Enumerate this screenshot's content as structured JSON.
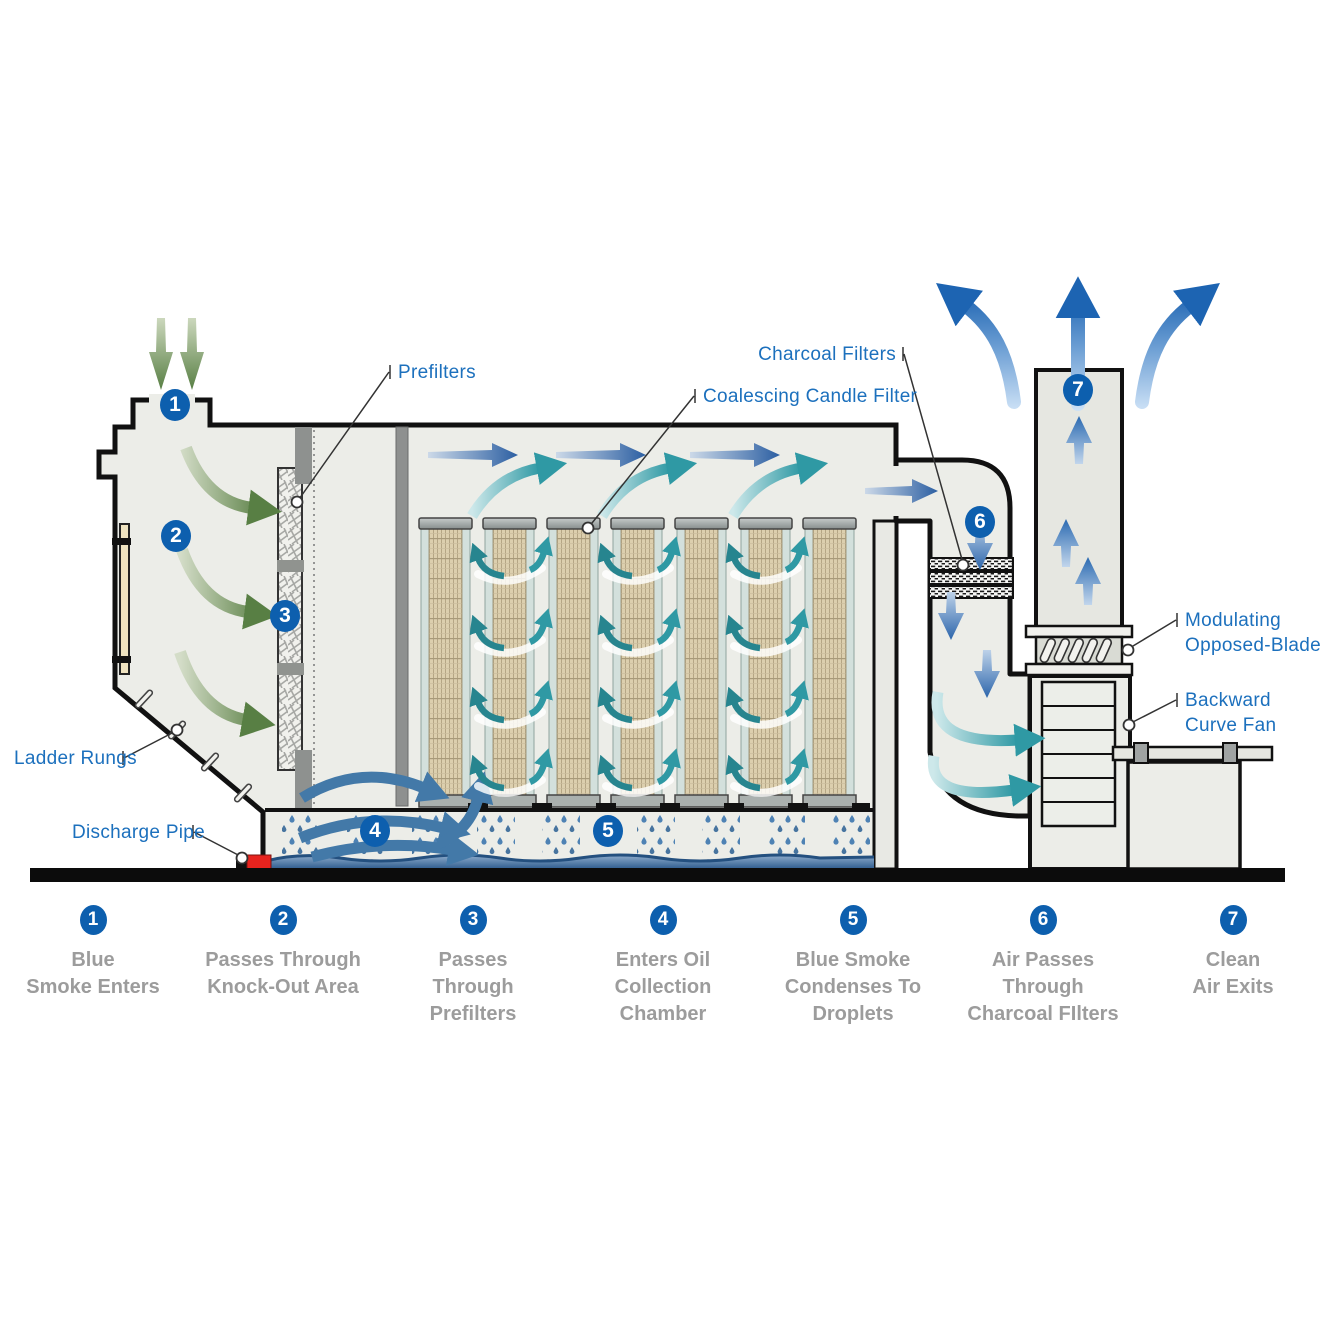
{
  "diagram": {
    "steps": [
      "1",
      "2",
      "3",
      "4",
      "5",
      "6",
      "7"
    ],
    "callouts": {
      "prefilters": "Prefilters",
      "coalescing": "Coalescing Candle Filter",
      "charcoal": "Charcoal Filters",
      "modulating_line1": "Modulating",
      "modulating_line2": "Opposed-Blade",
      "fan_line1": "Backward",
      "fan_line2": "Curve Fan",
      "ladder": "Ladder Rungs",
      "discharge": "Discharge Pipe"
    },
    "icons": {
      "inlet_arrows": "green-down-arrows",
      "exit_arrows": "blue-exit-arrows",
      "airflow_arrows": "blue-right-arrows",
      "swirl_arrows": "teal-swirl-arrows"
    },
    "colors": {
      "label_blue": "#1c70bd",
      "circle_blue": "#0d5fae",
      "legend_gray": "#9c9c9c",
      "housing_fill": "#ecede8",
      "green_arrow": "#587f44",
      "teal_arrow": "#2f99a4",
      "flow_blue": "#2c5fa2",
      "water_blue": "#2e5c8e",
      "discharge_red": "#e7231e"
    }
  },
  "legend": {
    "items": [
      {
        "number": "1",
        "lines": [
          "Blue",
          "Smoke Enters"
        ]
      },
      {
        "number": "2",
        "lines": [
          "Passes Through",
          "Knock-Out Area"
        ]
      },
      {
        "number": "3",
        "lines": [
          "Passes",
          "Through",
          "Prefilters"
        ]
      },
      {
        "number": "4",
        "lines": [
          "Enters Oil",
          "Collection",
          "Chamber"
        ]
      },
      {
        "number": "5",
        "lines": [
          "Blue Smoke",
          "Condenses To",
          "Droplets"
        ]
      },
      {
        "number": "6",
        "lines": [
          "Air Passes",
          "Through",
          "Charcoal FIlters"
        ]
      },
      {
        "number": "7",
        "lines": [
          "Clean",
          "Air Exits"
        ]
      }
    ]
  }
}
